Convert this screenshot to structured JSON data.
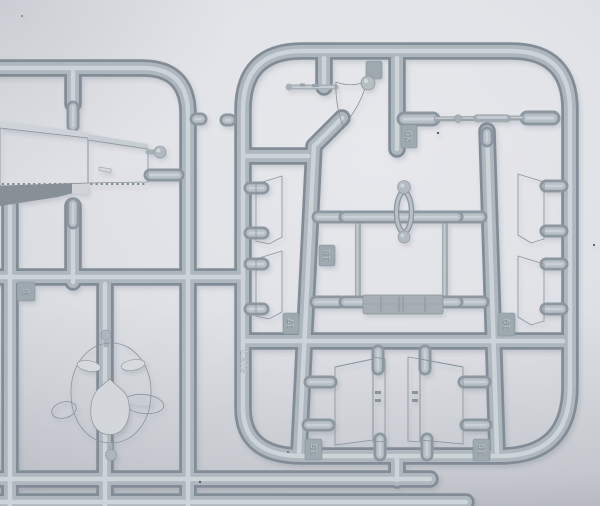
{
  "scene": {
    "description": "Macro photograph of a light grey injection-moulded model kit sprue (parts runner) with attached parts: a flat wing panel, an engine cowling with eye-shaped openings, side strips, a rectangular frame, a loop part, a curved fin, a long rod and two intake boxes, on a pale grey studio background",
    "colors": {
      "background": "#e0e2e7",
      "runner_highlight": "#d0d7dc",
      "runner_mid": "#aeb7bd",
      "runner_shadow": "#828c96",
      "part_grey": "#b2bac1",
      "opening_grey": "#d5d8dc"
    }
  },
  "mold_tags": {
    "tag_6": "6",
    "tag_15": "15",
    "tag_16": "16",
    "tag_17": "17",
    "tag_18": "18",
    "tag_19": "19",
    "tag_20": "20",
    "tag_late": "Late"
  }
}
